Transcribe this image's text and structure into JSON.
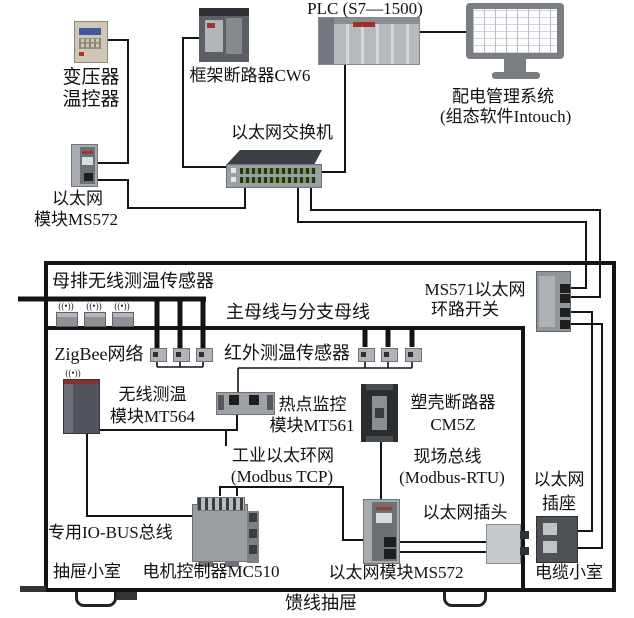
{
  "labels": {
    "plc": "PLC (S7—1500)",
    "cw6": "框架断路器CW6",
    "transformer_l1": "变压器",
    "transformer_l2": "温控器",
    "switch": "以太网交换机",
    "ms572_left_l1": "以太网",
    "ms572_left_l2": "模块MS572",
    "pms_l1": "配电管理系统",
    "pms_l2": "(组态软件Intouch)",
    "busbar_sensor": "母排无线测温传感器",
    "ms571_l1": "MS571以太网",
    "ms571_l2": "环路开关",
    "main_bus": "主母线与分支母线",
    "zigbee": "ZigBee网络",
    "infrared": "红外测温传感器",
    "mt564_l1": "无线测温",
    "mt564_l2": "模块MT564",
    "mt561_l1": "热点监控",
    "mt561_l2": "模块MT561",
    "cm5z_l1": "塑壳断路器",
    "cm5z_l2": "CM5Z",
    "ring_l1": "工业以太环网",
    "ring_l2": "(Modbus TCP)",
    "fieldbus_l1": "现场总线",
    "fieldbus_l2": "(Modbus-RTU)",
    "plug": "以太网插头",
    "socket_l1": "以太网",
    "socket_l2": "插座",
    "iobus": "专用IO-BUS总线",
    "drawer_cell": "抽屉小室",
    "mc510": "电机控制器MC510",
    "ms572_bottom": "以太网模块MS572",
    "cable_cell": "电缆小室",
    "feeder_drawer": "馈线抽屉"
  },
  "icons": {
    "antenna": "((•))"
  }
}
